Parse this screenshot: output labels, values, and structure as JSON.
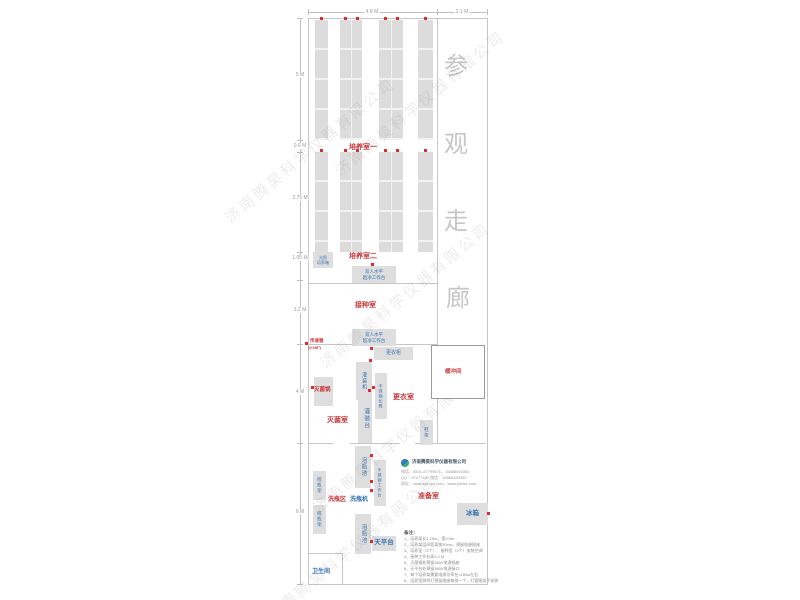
{
  "dims": {
    "top": [
      "4.8 M",
      "2.1 M"
    ],
    "left": [
      "5 M",
      "0.6 M",
      "3.75 M",
      "1.05 M",
      "3.2 M",
      "4 M",
      "6 M"
    ]
  },
  "corridor": [
    "参",
    "观",
    "走",
    "廊"
  ],
  "rooms": {
    "room1": "培养室一",
    "room2": "培养室二",
    "inoculation": "接种室",
    "sterilization": "灭菌室",
    "changing": "更衣室",
    "buffer": "缓冲间",
    "prep": "准备室",
    "wash_area": "洗瓶区",
    "toilet": "卫生间"
  },
  "equipment": {
    "light_incubator_l1": "光照",
    "light_incubator_l2": "培养箱",
    "clean_bench_l1": "双人水平",
    "clean_bench_l2": "超净工作台",
    "pass_window": "传递窗",
    "pass_window_size": "(0.6M²)",
    "wardrobe": "更衣柜",
    "filling_machine": "灌装机",
    "ss_bench": "不锈钢长凳",
    "sterilizer": "灭菌锅",
    "filling_table": "灌装台",
    "soaking_pool": "泡瓶池",
    "ss_worktable": "不锈钢工作台",
    "bottle_washer": "洗瓶机",
    "drying_rack": "晾瓶架",
    "shoe_rack": "鞋架",
    "fridge": "冰箱",
    "balance_table": "天平台"
  },
  "company": {
    "name": "济南腾昊科学仪器有限公司",
    "tel": "电话：0531-87799671，15866453352",
    "qq": "QQ：97477487   微信：15866453352",
    "web": "网址：www.sykxyq.com，www.jnthkx.com"
  },
  "notes": {
    "title": "备注：",
    "items": [
      "1、培养架长1.25m，宽0.5m",
      "2、培养架层间距离按30cm，预留电源插座",
      "3、培养室（3个）、接种室（2个）安装空调",
      "4、接种工作台高1.0 M",
      "5、灭菌锅处预留380V电源插座",
      "6、天平台处预留380V电源接口",
      "7、每个培养架需要电源功率在×150w左右",
      "8、培养室照明灯预留插座每排一个，灯管随架子安装"
    ]
  },
  "watermark": "济南腾昊科学仪器有限公司",
  "colors": {
    "red": "#c8393b",
    "blue": "#3572b0",
    "gray_box": "#dedede",
    "wall": "#c6c6c6"
  }
}
